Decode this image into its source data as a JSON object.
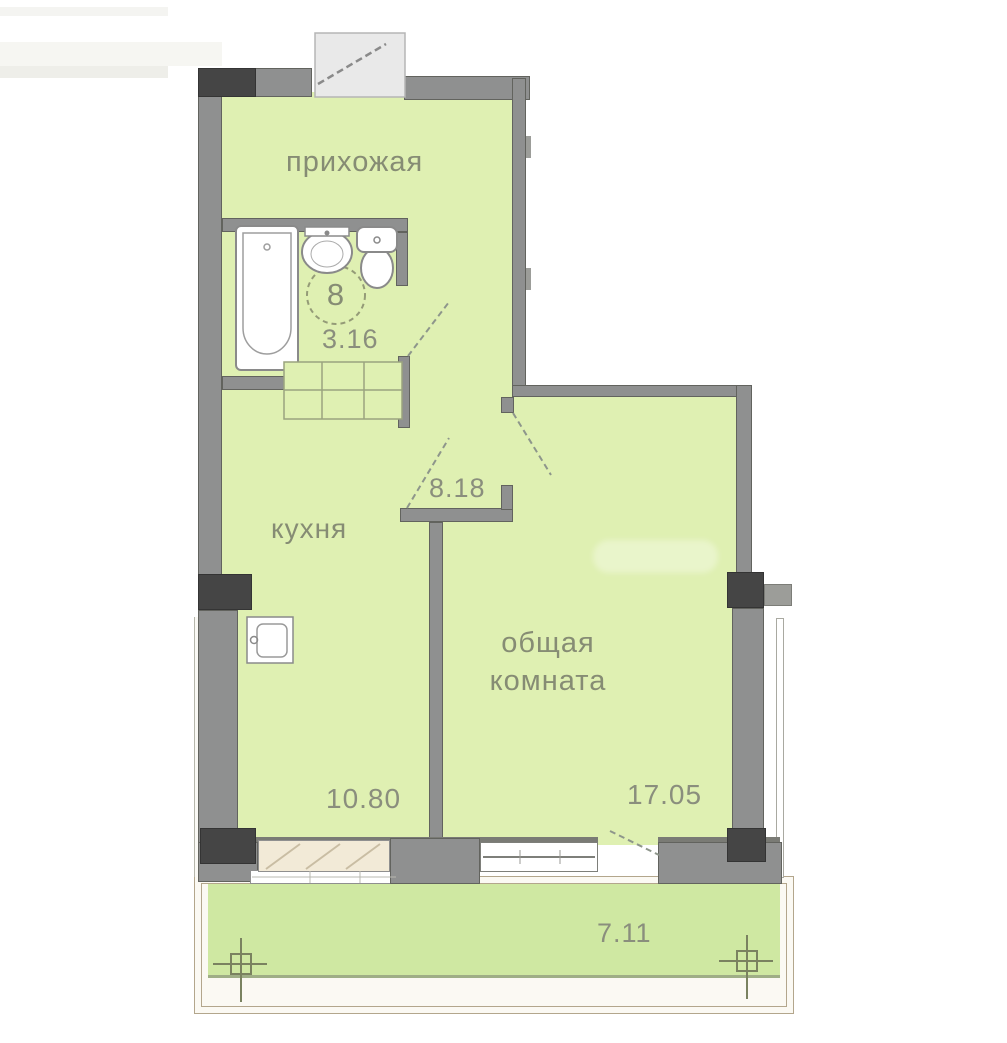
{
  "plan_title": "apartment-floor-plan",
  "rooms": {
    "hallway": {
      "label": "прихожая"
    },
    "bathroom": {
      "area": "3.16",
      "unit_number": "8"
    },
    "corridor": {
      "area": "8.18"
    },
    "kitchen": {
      "label": "кухня",
      "area": "10.80"
    },
    "living_room": {
      "label_line1": "общая",
      "label_line2": "комната",
      "area": "17.05"
    },
    "balcony": {
      "area": "7.11"
    }
  },
  "colors": {
    "floor_green": "#dff0b2",
    "balcony_green": "#cfe8a2",
    "wall_gray": "#8f9090",
    "wall_outline": "#62635e",
    "column_dark": "#454545",
    "window_beige": "#f2ead7",
    "balcony_outline": "#b3a68c",
    "label_text": "#868c74"
  }
}
